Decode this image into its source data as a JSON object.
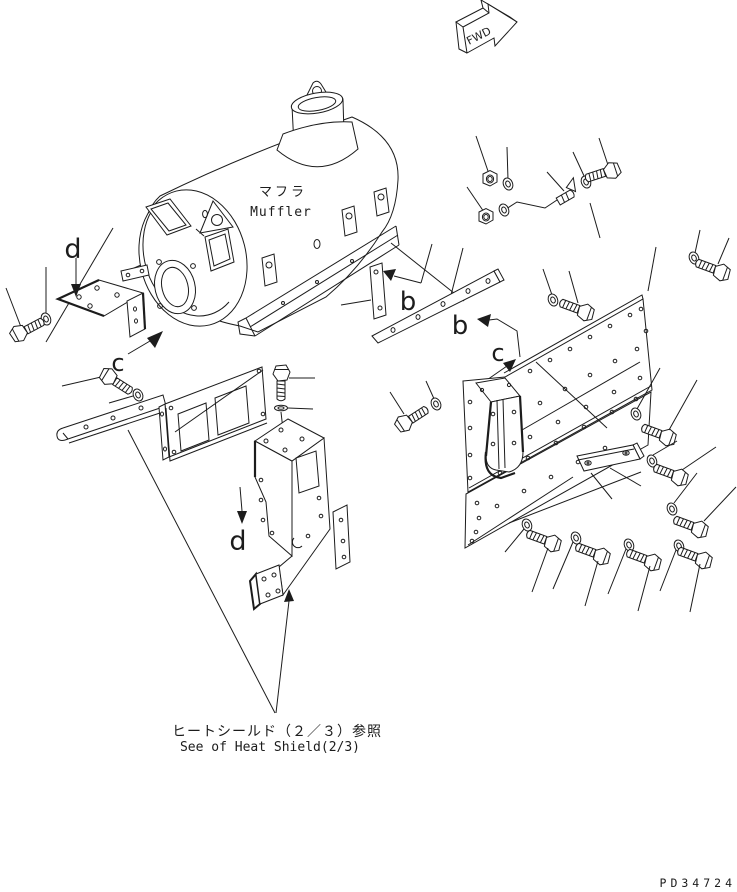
{
  "figure": {
    "fwd_label": "FWD",
    "muffler_label_jp": "マフラ",
    "muffler_label_en": "Muffler",
    "callouts": {
      "b": "b",
      "c": "c",
      "d": "d"
    },
    "reference_note_jp": "ヒートシールド（２／３）参照",
    "reference_note_en": "See of Heat Shield(2/3)",
    "drawing_number": "PD34724",
    "colors": {
      "line": "#1c1c1c",
      "background": "#ffffff"
    }
  }
}
